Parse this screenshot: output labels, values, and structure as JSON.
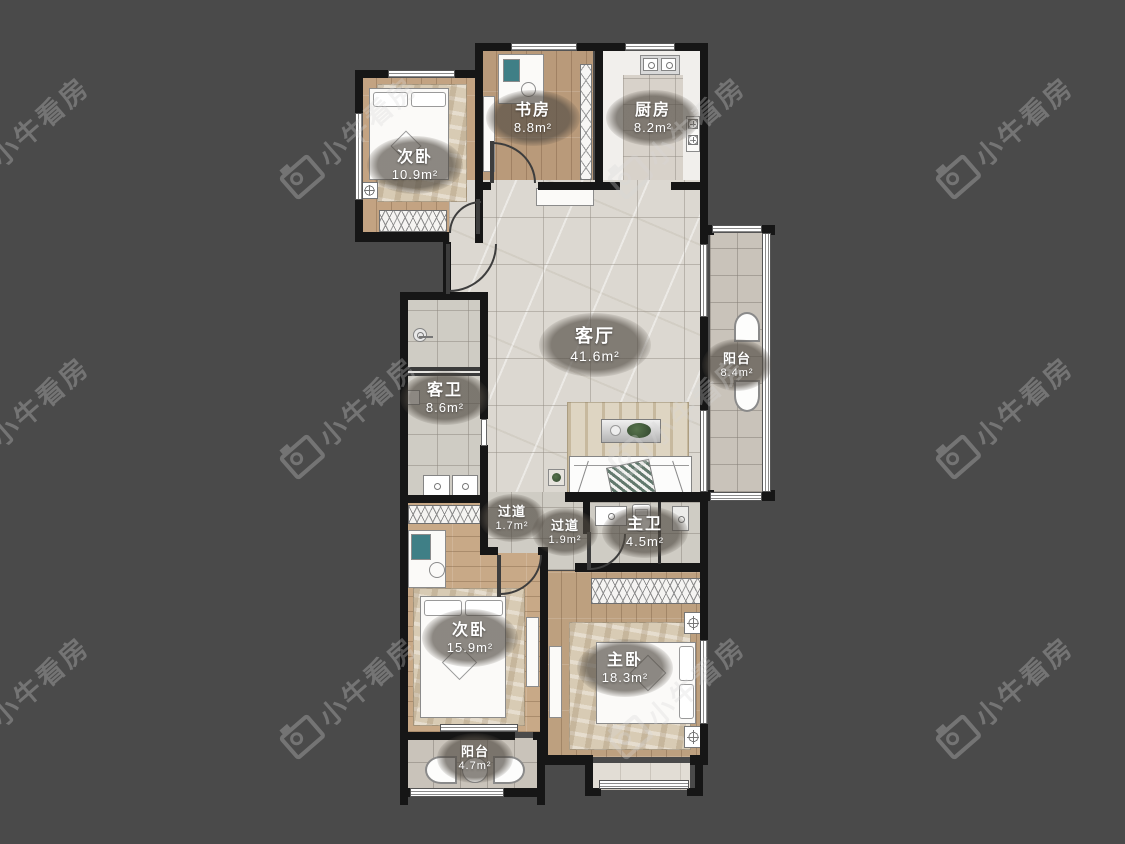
{
  "watermark": {
    "brand": "小牛看房"
  },
  "rooms": {
    "bedroom_tl": {
      "name": "次卧",
      "area": "10.9m²"
    },
    "study": {
      "name": "书房",
      "area": "8.8m²"
    },
    "kitchen": {
      "name": "厨房",
      "area": "8.2m²"
    },
    "living": {
      "name": "客厅",
      "area": "41.6m²"
    },
    "balcony_right": {
      "name": "阳台",
      "area": "8.4m²"
    },
    "guest_bath": {
      "name": "客卫",
      "area": "8.6m²"
    },
    "hallway_a": {
      "name": "过道",
      "area": "1.7m²"
    },
    "hallway_b": {
      "name": "过道",
      "area": "1.9m²"
    },
    "master_bath": {
      "name": "主卫",
      "area": "4.5m²"
    },
    "bedroom_bl": {
      "name": "次卧",
      "area": "15.9m²"
    },
    "master_bedroom": {
      "name": "主卧",
      "area": "18.3m²"
    },
    "balcony_bottom": {
      "name": "阳台",
      "area": "4.7m²"
    }
  },
  "colors": {
    "background": "#4a4a4a",
    "wall": "#161616",
    "wood": "#c3a382",
    "tile": "#dcd8d1",
    "label_bg": "rgba(80,74,66,0.65)"
  }
}
